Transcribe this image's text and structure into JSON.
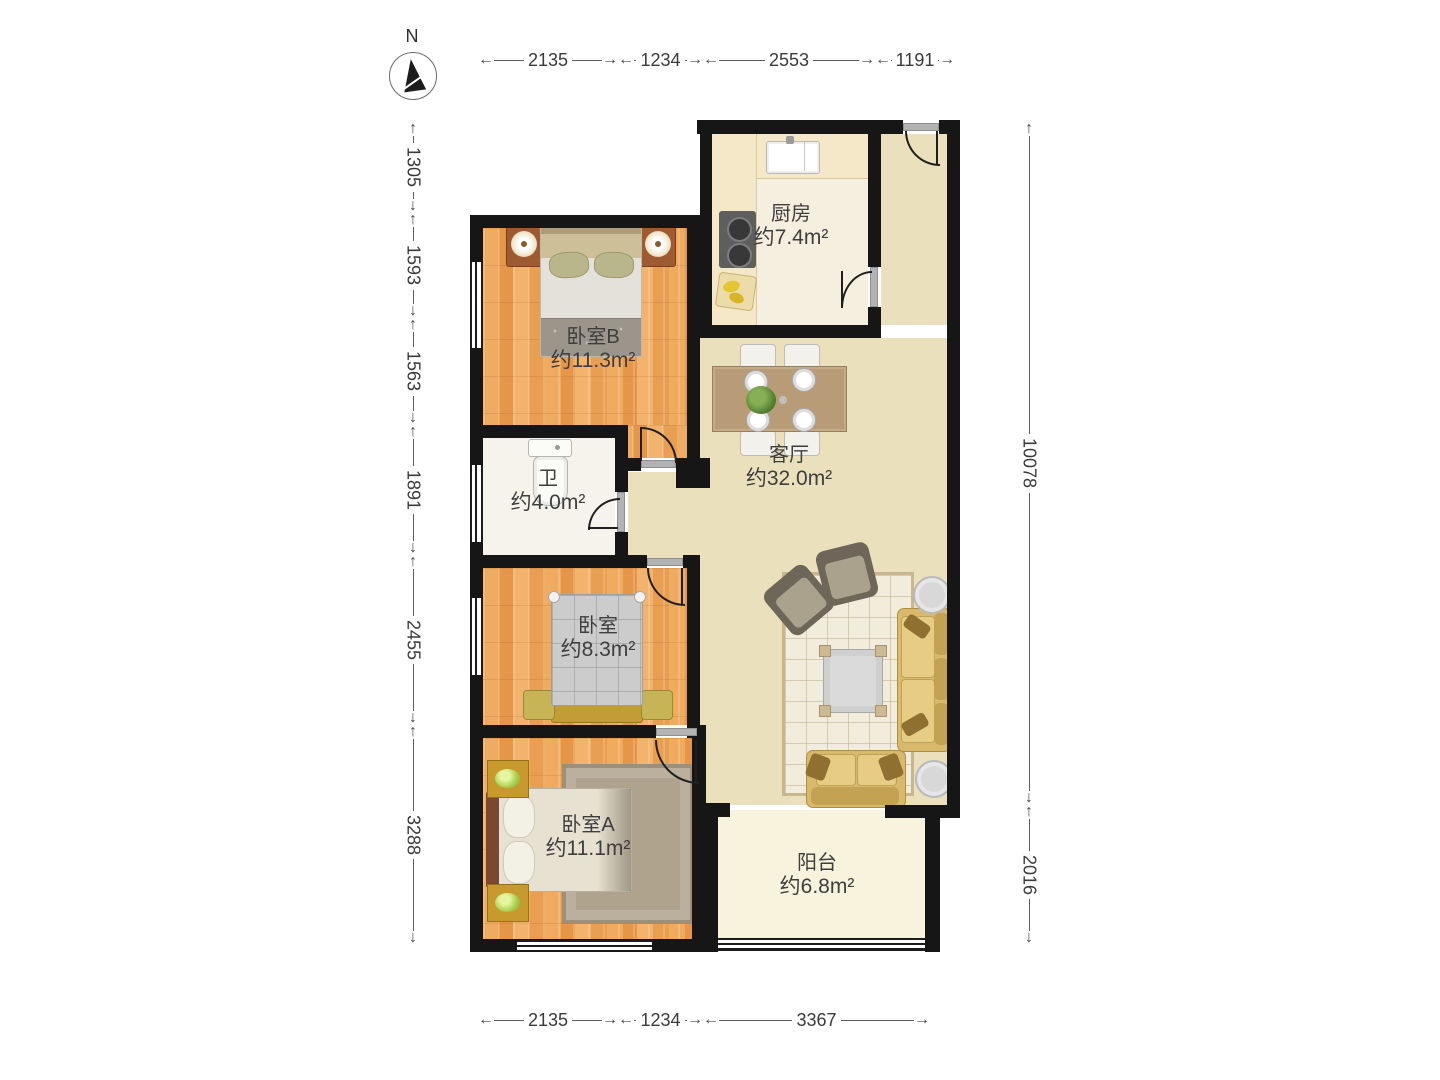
{
  "compass": {
    "label": "N"
  },
  "dimensions": {
    "top": [
      "2135",
      "1234",
      "2553",
      "1191"
    ],
    "bottom": [
      "2135",
      "1234",
      "3367"
    ],
    "left": [
      "1305",
      "1593",
      "1563",
      "1891",
      "2455",
      "3288"
    ],
    "right": [
      "10078",
      "2016"
    ]
  },
  "rooms": {
    "kitchen": {
      "name": "厨房",
      "area": "约7.4m²"
    },
    "bedroomB": {
      "name": "卧室B",
      "area": "约11.3m²"
    },
    "bathroom": {
      "name": "卫",
      "area": "约4.0m²"
    },
    "living": {
      "name": "客厅",
      "area": "约32.0m²"
    },
    "bedroomMid": {
      "name": "卧室",
      "area": "约8.3m²"
    },
    "bedroomA": {
      "name": "卧室A",
      "area": "约11.1m²"
    },
    "balcony": {
      "name": "阳台",
      "area": "约6.8m²"
    }
  },
  "colors": {
    "wall": "#161616",
    "wood_floor": "#eda85f",
    "living_floor": "#eae1bc",
    "balcony_floor": "#f7f3dd",
    "sofa_gold": "#d9ba6c",
    "counter_cream": "#f4e8c8"
  }
}
